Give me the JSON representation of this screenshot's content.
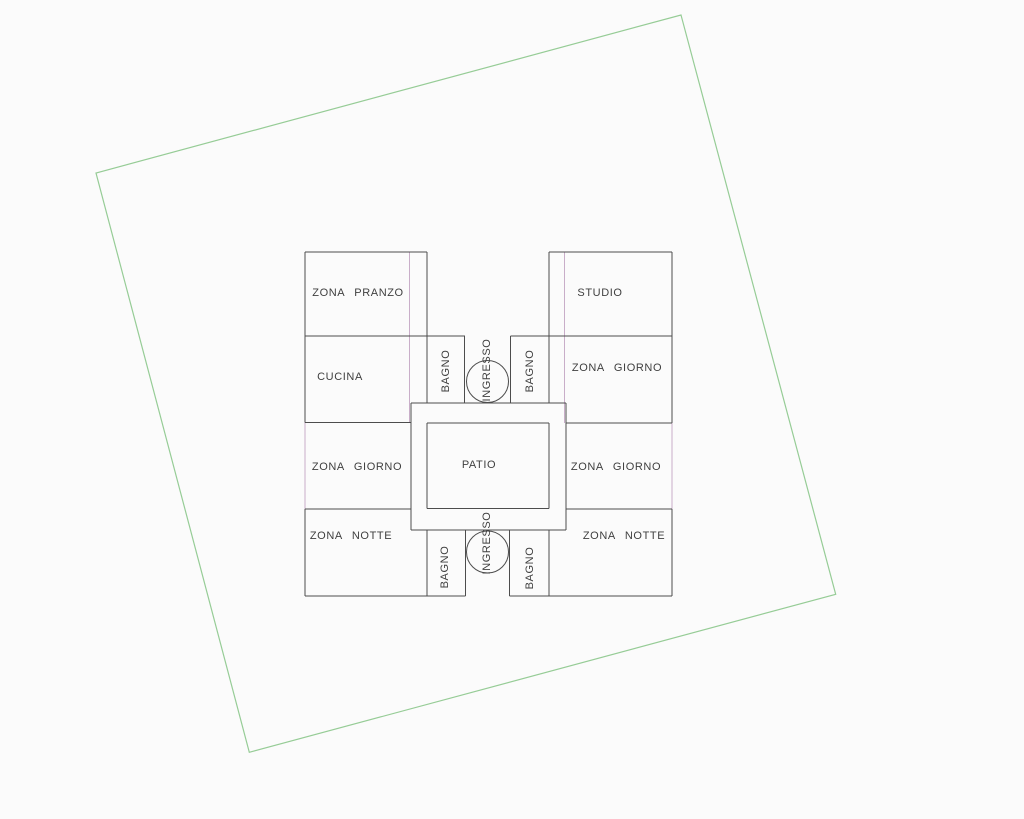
{
  "drawing": {
    "kind": "architectural floor plan (CAD)",
    "canvas": {
      "width": 1024,
      "height": 819
    },
    "colors": {
      "background": "#fbfbfb",
      "wall_line": "#4d4d4d",
      "window_line": "#c9aec9",
      "boundary_line": "#96cc96",
      "text": "#3f3f3f"
    },
    "site_boundary": {
      "points": [
        [
          681,
          15
        ],
        [
          835.7,
          594.3
        ],
        [
          249.3,
          752.3
        ],
        [
          96,
          173
        ]
      ]
    },
    "floor_plan": {
      "walls_h": [
        {
          "y": 252,
          "x1": 305,
          "x2": 427
        },
        {
          "y": 252,
          "x1": 549,
          "x2": 672
        },
        {
          "y": 336,
          "x1": 305,
          "x2": 465
        },
        {
          "y": 336,
          "x1": 510.5,
          "x2": 672
        },
        {
          "y": 403,
          "x1": 411,
          "x2": 566
        },
        {
          "y": 422.5,
          "x1": 305,
          "x2": 411
        },
        {
          "y": 423,
          "x1": 427,
          "x2": 549
        },
        {
          "y": 423,
          "x1": 566,
          "x2": 672
        },
        {
          "y": 508.5,
          "x1": 427,
          "x2": 549
        },
        {
          "y": 509,
          "x1": 305,
          "x2": 411
        },
        {
          "y": 509,
          "x1": 566,
          "x2": 672
        },
        {
          "y": 530,
          "x1": 411,
          "x2": 566
        },
        {
          "y": 596,
          "x1": 305,
          "x2": 465.5
        },
        {
          "y": 596,
          "x1": 509.5,
          "x2": 672
        }
      ],
      "walls_v": [
        {
          "x": 305,
          "y1": 252,
          "y2": 422.5
        },
        {
          "x": 305,
          "y1": 509,
          "y2": 596
        },
        {
          "x": 672,
          "y1": 252,
          "y2": 423
        },
        {
          "x": 672,
          "y1": 509,
          "y2": 596
        },
        {
          "x": 427,
          "y1": 252,
          "y2": 403
        },
        {
          "x": 427,
          "y1": 423,
          "y2": 508.5
        },
        {
          "x": 427,
          "y1": 530,
          "y2": 596
        },
        {
          "x": 549,
          "y1": 252,
          "y2": 403
        },
        {
          "x": 549,
          "y1": 423,
          "y2": 508.5
        },
        {
          "x": 549,
          "y1": 530,
          "y2": 596
        },
        {
          "x": 464.5,
          "y1": 336,
          "y2": 403
        },
        {
          "x": 510.5,
          "y1": 336,
          "y2": 403
        },
        {
          "x": 465.5,
          "y1": 530,
          "y2": 596
        },
        {
          "x": 509.5,
          "y1": 530,
          "y2": 596
        },
        {
          "x": 411,
          "y1": 403,
          "y2": 530
        },
        {
          "x": 566,
          "y1": 403,
          "y2": 530
        }
      ],
      "windows_v": [
        {
          "x": 409.5,
          "y1": 252,
          "y2": 422.5
        },
        {
          "x": 564.5,
          "y1": 252,
          "y2": 423
        },
        {
          "x": 305,
          "y1": 422.5,
          "y2": 509
        },
        {
          "x": 672,
          "y1": 423,
          "y2": 509
        }
      ],
      "door_circles": [
        {
          "cx": 487.5,
          "cy": 381.5,
          "r": 21
        },
        {
          "cx": 487.5,
          "cy": 552,
          "r": 21
        }
      ],
      "labels": [
        {
          "text": "ZONA PRANZO",
          "x": 358,
          "y": 293,
          "rotated": false,
          "name": "zona-pranzo"
        },
        {
          "text": "STUDIO",
          "x": 600,
          "y": 293,
          "rotated": false,
          "name": "studio"
        },
        {
          "text": "CUCINA",
          "x": 340,
          "y": 377,
          "rotated": false,
          "name": "cucina"
        },
        {
          "text": "BAGNO",
          "x": 446,
          "y": 371,
          "rotated": true,
          "name": "bagno-top-left"
        },
        {
          "text": "INGRESSO",
          "x": 487,
          "y": 370,
          "rotated": true,
          "name": "ingresso-top"
        },
        {
          "text": "BAGNO",
          "x": 530,
          "y": 371,
          "rotated": true,
          "name": "bagno-top-right"
        },
        {
          "text": "ZONA GIORNO",
          "x": 617,
          "y": 368,
          "rotated": false,
          "name": "zona-giorno-upper-right"
        },
        {
          "text": "ZONA GIORNO",
          "x": 357,
          "y": 467,
          "rotated": false,
          "name": "zona-giorno-left"
        },
        {
          "text": "PATIO",
          "x": 479,
          "y": 465,
          "rotated": false,
          "name": "patio"
        },
        {
          "text": "ZONA GIORNO",
          "x": 616,
          "y": 467,
          "rotated": false,
          "name": "zona-giorno-right"
        },
        {
          "text": "ZONA NOTTE",
          "x": 351,
          "y": 536,
          "rotated": false,
          "name": "zona-notte-left"
        },
        {
          "text": "ZONA NOTTE",
          "x": 624,
          "y": 536,
          "rotated": false,
          "name": "zona-notte-right"
        },
        {
          "text": "BAGNO",
          "x": 445,
          "y": 567,
          "rotated": true,
          "name": "bagno-bottom-left"
        },
        {
          "text": "INGRESSO",
          "x": 487,
          "y": 543,
          "rotated": true,
          "name": "ingresso-bottom"
        },
        {
          "text": "BAGNO",
          "x": 530,
          "y": 568,
          "rotated": true,
          "name": "bagno-bottom-right"
        }
      ]
    }
  }
}
